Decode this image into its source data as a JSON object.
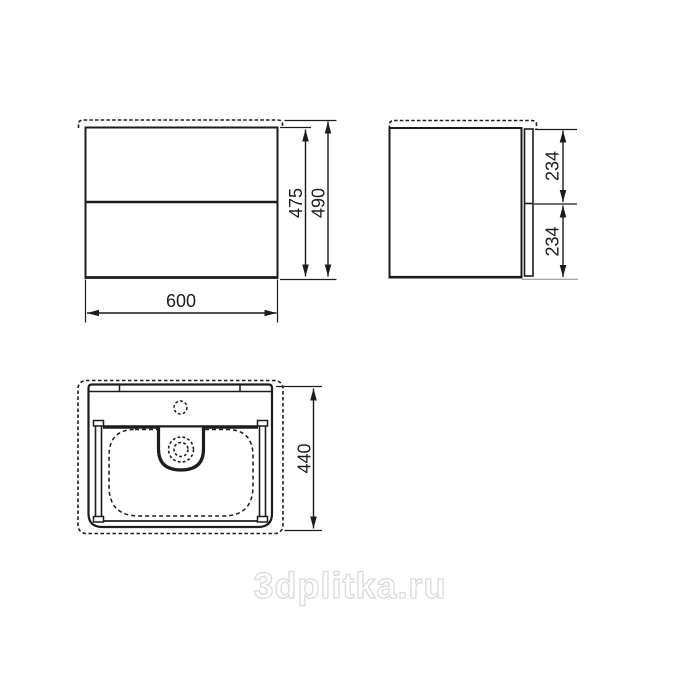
{
  "views": {
    "front": {
      "dims": {
        "width": "600",
        "height_cabinet": "475",
        "height_total": "490"
      }
    },
    "side": {
      "dims": {
        "upper_drawer": "234",
        "lower_drawer": "234"
      }
    },
    "plan": {
      "dims": {
        "depth": "440"
      }
    }
  },
  "watermark": {
    "text": "3dplitka.ru"
  },
  "colors": {
    "line": "#1c1c1c",
    "watermark": "#d9d9d9",
    "background": "#ffffff"
  }
}
